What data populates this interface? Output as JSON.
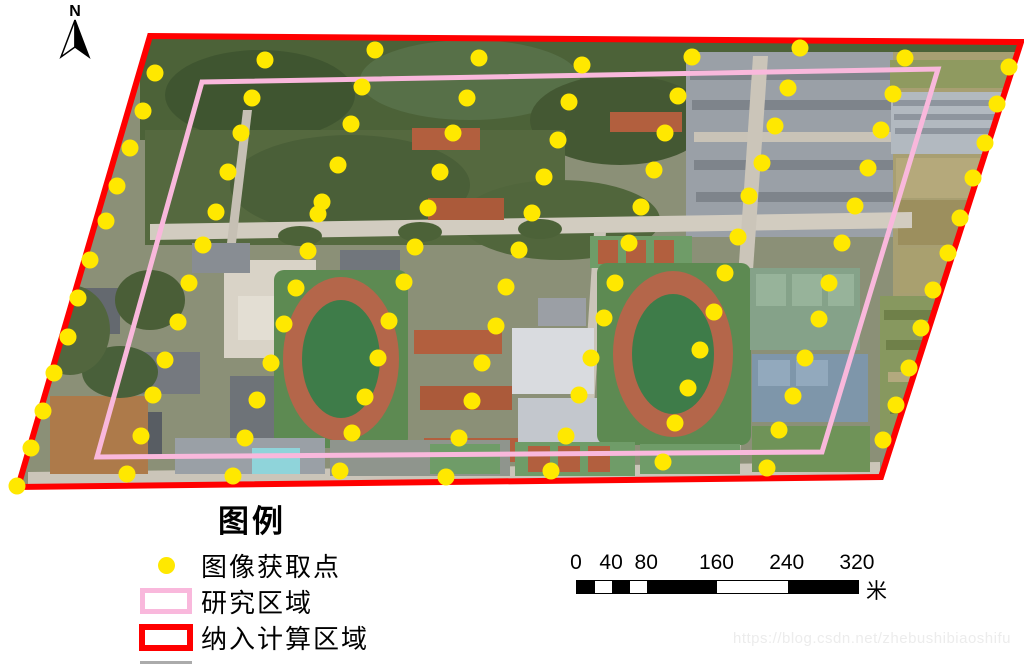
{
  "colors": {
    "point": "#FFE800",
    "study_area": "#F9B8DC",
    "calc_area": "#FF0000"
  },
  "map": {
    "north_label": "N",
    "point_radius": 8.5,
    "calc_area_polygon": [
      [
        150,
        36
      ],
      [
        1021,
        42
      ],
      [
        881,
        477
      ],
      [
        18,
        487
      ]
    ],
    "study_area_polygon": [
      [
        202,
        82
      ],
      [
        938,
        69
      ],
      [
        822,
        452
      ],
      [
        97,
        457
      ]
    ],
    "acquisition_points": [
      [
        155,
        73
      ],
      [
        265,
        60
      ],
      [
        375,
        50
      ],
      [
        479,
        58
      ],
      [
        582,
        65
      ],
      [
        692,
        57
      ],
      [
        800,
        48
      ],
      [
        905,
        58
      ],
      [
        1009,
        67
      ],
      [
        143,
        111
      ],
      [
        252,
        98
      ],
      [
        362,
        87
      ],
      [
        467,
        98
      ],
      [
        569,
        102
      ],
      [
        678,
        96
      ],
      [
        788,
        88
      ],
      [
        893,
        94
      ],
      [
        997,
        104
      ],
      [
        130,
        148
      ],
      [
        241,
        133
      ],
      [
        351,
        124
      ],
      [
        453,
        133
      ],
      [
        558,
        140
      ],
      [
        665,
        133
      ],
      [
        775,
        126
      ],
      [
        881,
        130
      ],
      [
        985,
        143
      ],
      [
        117,
        186
      ],
      [
        228,
        172
      ],
      [
        338,
        165
      ],
      [
        440,
        172
      ],
      [
        544,
        177
      ],
      [
        654,
        170
      ],
      [
        762,
        163
      ],
      [
        868,
        168
      ],
      [
        973,
        178
      ],
      [
        106,
        221
      ],
      [
        216,
        212
      ],
      [
        322,
        202
      ],
      [
        318,
        214
      ],
      [
        428,
        208
      ],
      [
        532,
        213
      ],
      [
        641,
        207
      ],
      [
        749,
        196
      ],
      [
        855,
        206
      ],
      [
        960,
        218
      ],
      [
        90,
        260
      ],
      [
        203,
        245
      ],
      [
        308,
        251
      ],
      [
        415,
        247
      ],
      [
        519,
        250
      ],
      [
        629,
        243
      ],
      [
        738,
        237
      ],
      [
        842,
        243
      ],
      [
        948,
        253
      ],
      [
        78,
        298
      ],
      [
        189,
        283
      ],
      [
        296,
        288
      ],
      [
        404,
        282
      ],
      [
        506,
        287
      ],
      [
        615,
        283
      ],
      [
        725,
        273
      ],
      [
        829,
        283
      ],
      [
        933,
        290
      ],
      [
        68,
        337
      ],
      [
        178,
        322
      ],
      [
        284,
        324
      ],
      [
        389,
        321
      ],
      [
        496,
        326
      ],
      [
        604,
        318
      ],
      [
        714,
        312
      ],
      [
        819,
        319
      ],
      [
        921,
        328
      ],
      [
        54,
        373
      ],
      [
        165,
        360
      ],
      [
        271,
        363
      ],
      [
        378,
        358
      ],
      [
        482,
        363
      ],
      [
        591,
        358
      ],
      [
        700,
        350
      ],
      [
        805,
        358
      ],
      [
        909,
        368
      ],
      [
        43,
        411
      ],
      [
        153,
        395
      ],
      [
        257,
        400
      ],
      [
        365,
        397
      ],
      [
        472,
        401
      ],
      [
        579,
        395
      ],
      [
        688,
        388
      ],
      [
        793,
        396
      ],
      [
        896,
        405
      ],
      [
        31,
        448
      ],
      [
        141,
        436
      ],
      [
        245,
        438
      ],
      [
        352,
        433
      ],
      [
        459,
        438
      ],
      [
        566,
        436
      ],
      [
        675,
        423
      ],
      [
        779,
        430
      ],
      [
        883,
        440
      ],
      [
        17,
        486
      ],
      [
        127,
        474
      ],
      [
        233,
        476
      ],
      [
        340,
        471
      ],
      [
        446,
        477
      ],
      [
        551,
        471
      ],
      [
        663,
        462
      ],
      [
        767,
        468
      ]
    ]
  },
  "legend": {
    "title": "图例",
    "items": [
      {
        "label": "图像获取点",
        "type": "point"
      },
      {
        "label": "研究区域",
        "type": "study"
      },
      {
        "label": "纳入计算区域",
        "type": "calc"
      }
    ]
  },
  "scalebar": {
    "ticks": [
      0,
      40,
      80,
      160,
      240,
      320
    ],
    "unit": "米",
    "total_m": 320,
    "px_per_m": 0.878,
    "segments": [
      [
        0,
        20,
        "#000000"
      ],
      [
        20,
        40,
        "#ffffff"
      ],
      [
        40,
        60,
        "#000000"
      ],
      [
        60,
        80,
        "#ffffff"
      ],
      [
        80,
        160,
        "#000000"
      ],
      [
        160,
        240,
        "#ffffff"
      ],
      [
        240,
        320,
        "#000000"
      ]
    ]
  },
  "watermark": "https://blog.csdn.net/zhebushibiaoshifu"
}
